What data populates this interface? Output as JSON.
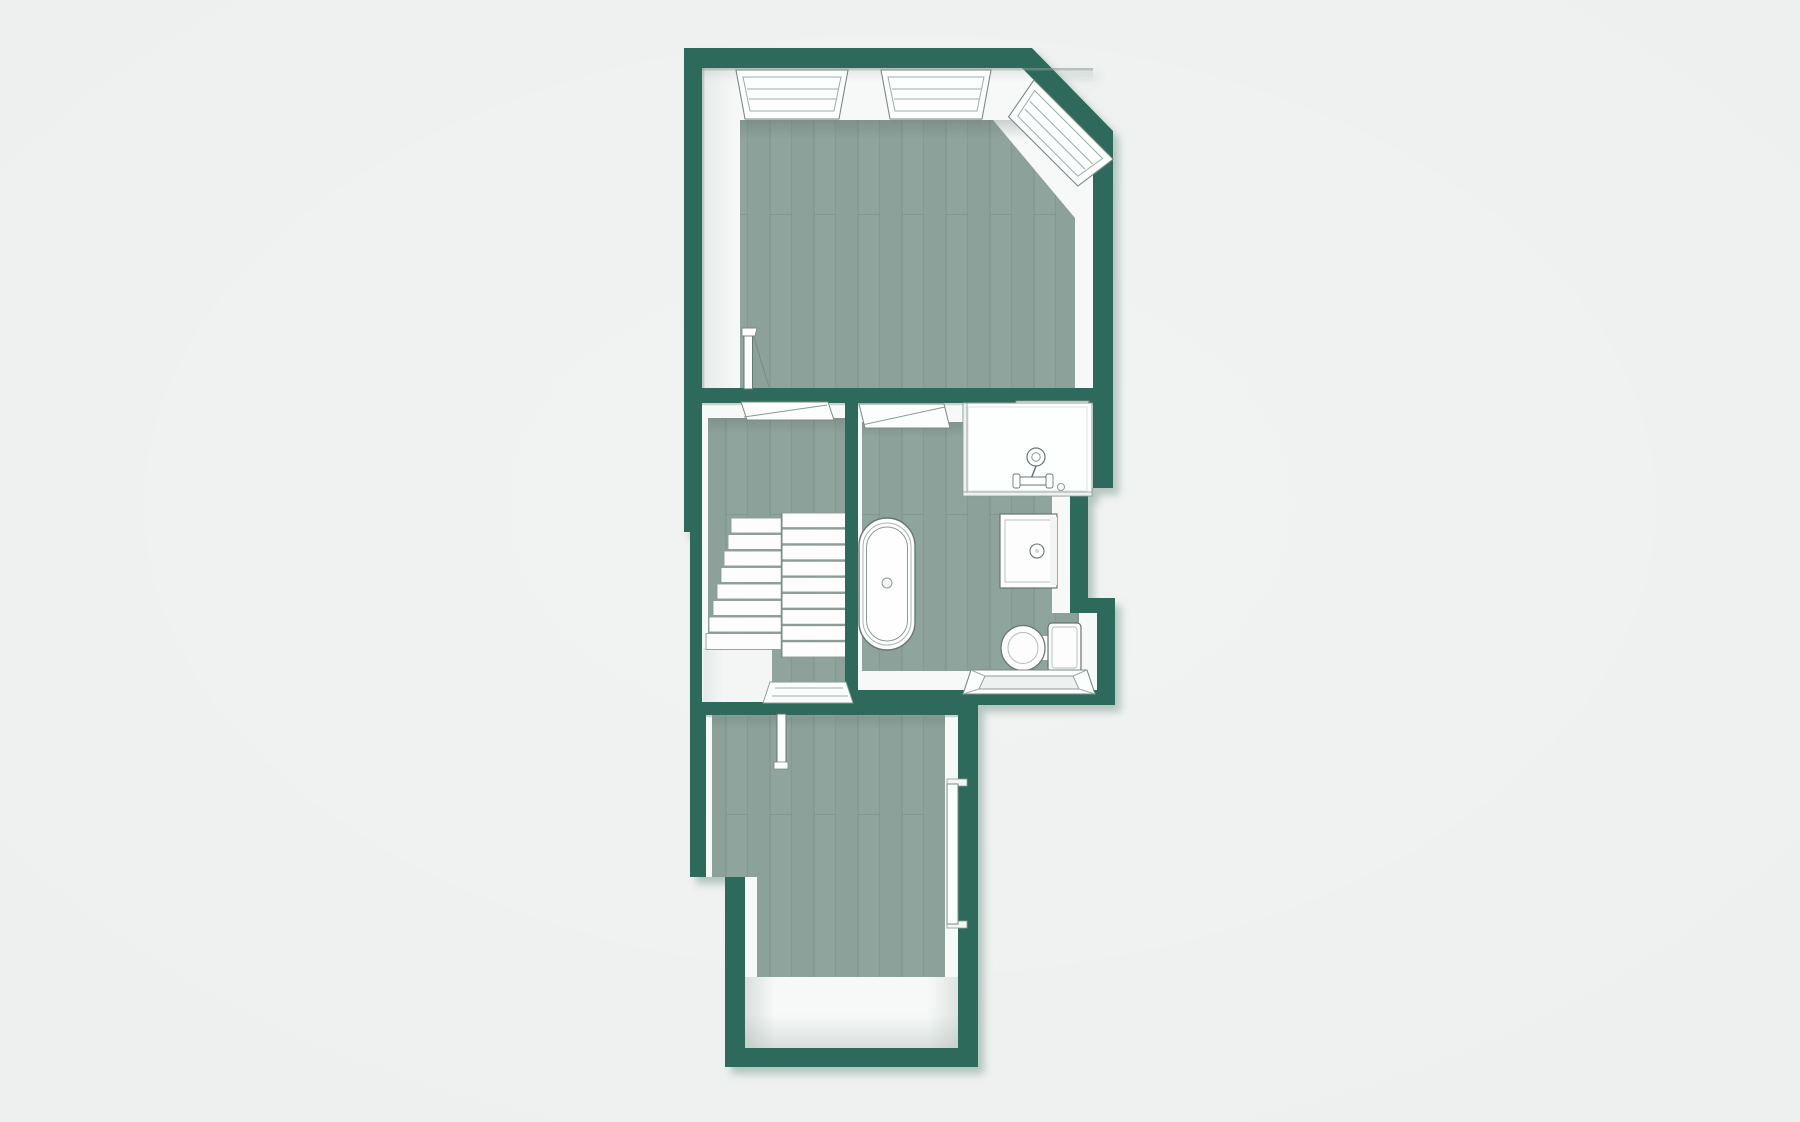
{
  "floorplan": {
    "view": "top-down-3d-render",
    "colors": {
      "background": "#EDF0EF",
      "wall": "#2E6B5C",
      "wall_shadow": "#5C8074",
      "floor_wood": "#8FA49D",
      "floor_light": "#F7F9F8",
      "fixture_outline": "#68776F"
    },
    "rooms": [
      {
        "id": "top-room",
        "floor": "wood",
        "features": [
          "window",
          "window",
          "corner-window",
          "door"
        ]
      },
      {
        "id": "stair-landing",
        "floor": "wood",
        "features": [
          "staircase",
          "doorway",
          "doorway"
        ]
      },
      {
        "id": "bathroom",
        "floor": "wood",
        "features": [
          "doorway",
          "shower-enclosure",
          "skylight-window",
          "sink-vanity",
          "bathtub",
          "toilet",
          "window"
        ]
      },
      {
        "id": "lower-hallway",
        "floor": "wood-and-light",
        "features": [
          "door-leaf",
          "wall-door"
        ]
      }
    ]
  }
}
